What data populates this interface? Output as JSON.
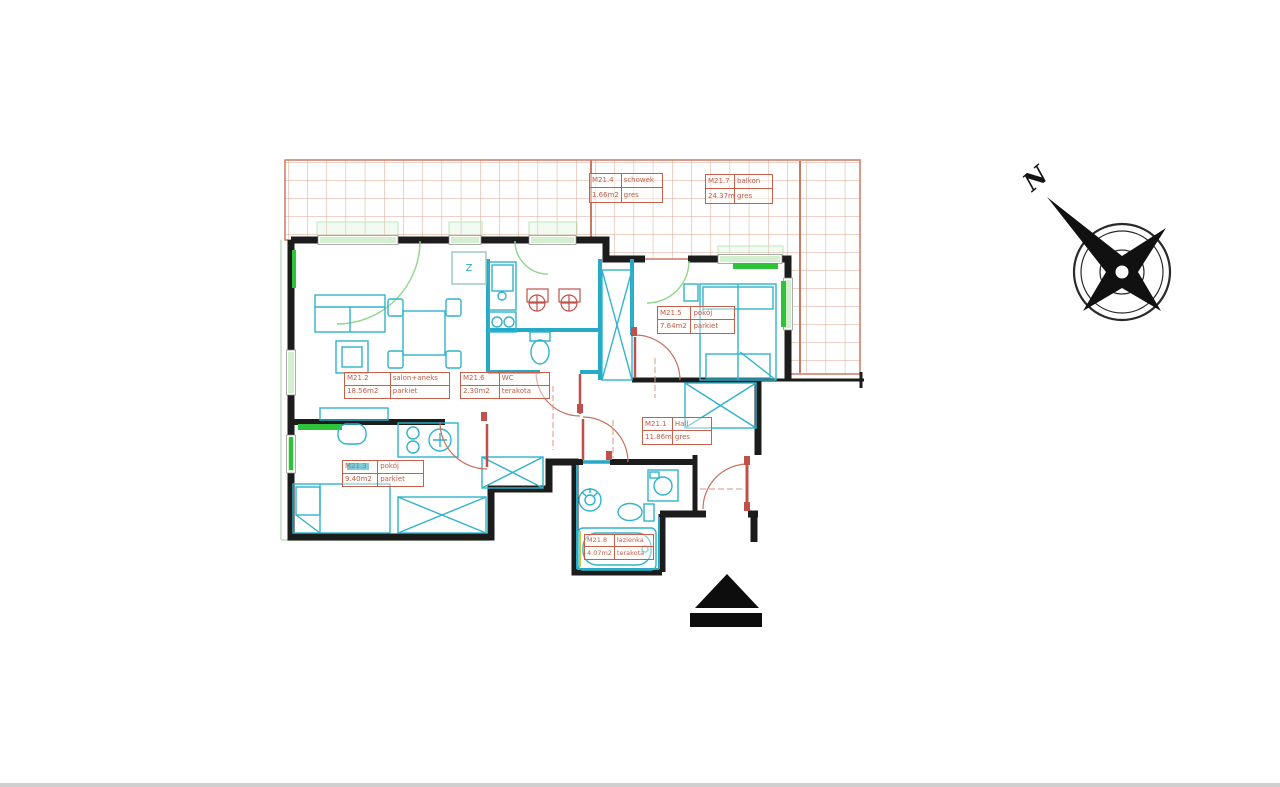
{
  "drawing": {
    "type": "apartment floor plan",
    "apartment_code": "M21"
  },
  "rooms": [
    {
      "id": "M21.4",
      "name": "schowek",
      "area": "1.66m2",
      "floor": "gres"
    },
    {
      "id": "M21.7",
      "name": "balkon",
      "area": "24.37m2",
      "floor": "gres"
    },
    {
      "id": "M21.2",
      "name": "salon+aneks",
      "area": "18.56m2",
      "floor": "parkiet"
    },
    {
      "id": "M21.6",
      "name": "WC",
      "area": "2.30m2",
      "floor": "terakota"
    },
    {
      "id": "M21.5",
      "name": "pokój",
      "area": "7.64m2",
      "floor": "parkiet"
    },
    {
      "id": "M21.1",
      "name": "Hall",
      "area": "11.86m2",
      "floor": "gres"
    },
    {
      "id": "M21.3",
      "name": "pokój",
      "area": "9.40m2",
      "floor": "parkiet"
    },
    {
      "id": "M21.8",
      "name": "łazienka",
      "area": "4.07m2",
      "floor": "terakota"
    }
  ],
  "annotations": {
    "z_label": "Z"
  },
  "compass": {
    "north_label": "N"
  },
  "icons": {
    "compass": "compass-rose",
    "entrance": "entrance-triangle-marker"
  },
  "colors": {
    "walls": "#1c1c1c",
    "fixtures_teal": "#2fb3cc",
    "windows_green": "#2ec43a",
    "labels_red": "#bf5d48",
    "balcony_grid": "#c97a63"
  }
}
